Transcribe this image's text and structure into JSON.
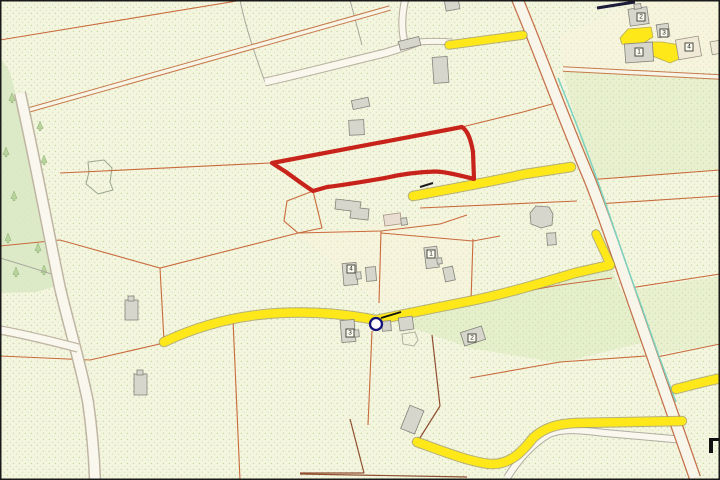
{
  "map": {
    "kind": "cadastral-title-plan",
    "visible_text_note": "only plot number labels are rendered on the map",
    "highlight_parcel": {
      "style": "thick-red-outline",
      "color": "#c8231a"
    },
    "location_marker": {
      "shape": "circle-outline",
      "color": "#141478",
      "x": 376,
      "y": 324
    },
    "colors": {
      "map_background": "#f3f5df",
      "stipple_dot": "#a9c87f",
      "field_boundary": "#c96a3c",
      "dark_boundary": "#8f4f30",
      "road_yellow": "#ffe819",
      "track_fill": "#f8f5ea",
      "stream_teal": "#7cd2c0",
      "building_gray": "#d6d6cd",
      "building_cream": "#efe9d6",
      "forest_green": "#d7e8c4",
      "frame_black": "#1a1a1a"
    },
    "plot_labels_center": [
      {
        "label": "4",
        "x": 351,
        "y": 269
      },
      {
        "label": "1",
        "x": 431,
        "y": 254
      },
      {
        "label": "3",
        "x": 350,
        "y": 333
      },
      {
        "label": "2",
        "x": 472,
        "y": 338
      }
    ],
    "plot_labels_northeast": [
      {
        "label": "2",
        "x": 641,
        "y": 17
      },
      {
        "label": "3",
        "x": 664,
        "y": 33
      },
      {
        "label": "1",
        "x": 639,
        "y": 52
      },
      {
        "label": "4",
        "x": 689,
        "y": 47
      }
    ]
  }
}
